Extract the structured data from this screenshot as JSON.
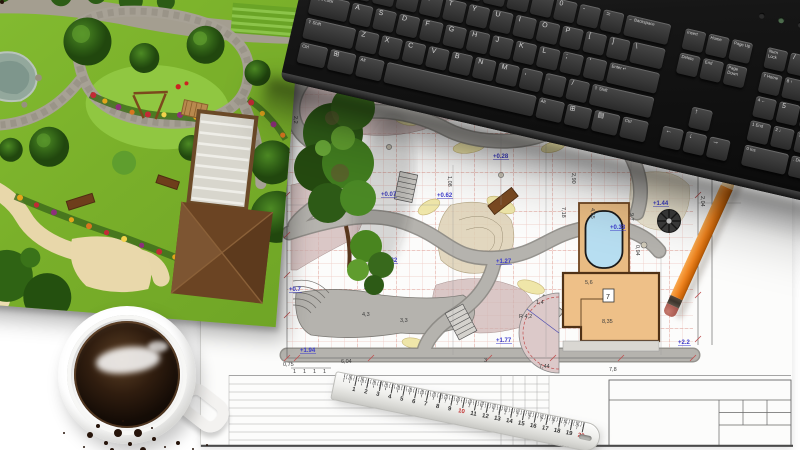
{
  "scene_title": "Garden landscape design workspace photo",
  "colors": {
    "lawn_green": "#7db32c",
    "plan_grid_pink": "#eec6c0",
    "plan_grid_red": "#dc958b",
    "elevation_blue": "#3a3acc",
    "pool_blue": "#b7def1",
    "deck_tan": "#e9bc83",
    "pencil_orange": "#ef8420",
    "ruler_red": "#c03030",
    "keyboard_black": "#161616"
  },
  "keyboard": {
    "unit": 24,
    "keyH": 21,
    "rows": [
      {
        "y": 88,
        "x": 12,
        "keys": [
          [
            "`",
            1
          ],
          [
            "1",
            1
          ],
          [
            "2",
            1
          ],
          [
            "3",
            1
          ],
          [
            "4",
            1
          ],
          [
            "5",
            1
          ],
          [
            "6",
            1
          ],
          [
            "7",
            1
          ],
          [
            "8",
            1
          ],
          [
            "9",
            1
          ],
          [
            "0",
            1
          ],
          [
            "-",
            1
          ],
          [
            "=",
            1
          ],
          [
            "← Backspace",
            2,
            "s"
          ]
        ]
      },
      {
        "y": 113,
        "x": 12,
        "keys": [
          [
            "Tab",
            1.5,
            "s"
          ],
          [
            "Q",
            1
          ],
          [
            "W",
            1
          ],
          [
            "E",
            1
          ],
          [
            "R",
            1
          ],
          [
            "T",
            1
          ],
          [
            "Y",
            1
          ],
          [
            "U",
            1
          ],
          [
            "I",
            1
          ],
          [
            "O",
            1
          ],
          [
            "P",
            1
          ],
          [
            "[",
            1
          ],
          [
            "]",
            1
          ],
          [
            "\\",
            1.5
          ]
        ]
      },
      {
        "y": 138,
        "x": 12,
        "keys": [
          [
            "Caps Lock",
            1.75,
            "s"
          ],
          [
            "A",
            1
          ],
          [
            "S",
            1
          ],
          [
            "D",
            1
          ],
          [
            "F",
            1
          ],
          [
            "G",
            1
          ],
          [
            "H",
            1
          ],
          [
            "J",
            1
          ],
          [
            "K",
            1
          ],
          [
            "L",
            1
          ],
          [
            ";",
            1
          ],
          [
            "'",
            1
          ],
          [
            "Enter ↵",
            2.25,
            "s"
          ]
        ]
      },
      {
        "y": 163,
        "x": 12,
        "keys": [
          [
            "⇧ Shift",
            2.25,
            "s"
          ],
          [
            "Z",
            1
          ],
          [
            "X",
            1
          ],
          [
            "C",
            1
          ],
          [
            "V",
            1
          ],
          [
            "B",
            1
          ],
          [
            "N",
            1
          ],
          [
            "M",
            1
          ],
          [
            ",",
            1
          ],
          [
            ".",
            1
          ],
          [
            "/",
            1
          ],
          [
            "⇧ Shift",
            2.75,
            "s"
          ]
        ]
      },
      {
        "y": 188,
        "x": 12,
        "keys": [
          [
            "Ctrl",
            1.3,
            "s"
          ],
          [
            "⊞",
            1.2
          ],
          [
            "Alt",
            1.2,
            "s"
          ],
          [
            "",
            6.5
          ],
          [
            "Alt",
            1.2,
            "s"
          ],
          [
            "⊞",
            1.2
          ],
          [
            "▤",
            1.2
          ],
          [
            "Ctrl",
            1.2,
            "s"
          ]
        ]
      },
      {
        "y": 88,
        "x": 384,
        "keys": [
          [
            "Insert",
            1,
            "s"
          ],
          [
            "Home",
            1,
            "s"
          ],
          [
            "Page Up",
            1,
            "s"
          ]
        ]
      },
      {
        "y": 113,
        "x": 384,
        "keys": [
          [
            "Delete",
            1,
            "s"
          ],
          [
            "End",
            1,
            "s"
          ],
          [
            "Page Down",
            1,
            "s"
          ]
        ]
      },
      {
        "y": 163,
        "x": 408,
        "keys": [
          [
            "↑",
            1
          ]
        ]
      },
      {
        "y": 188,
        "x": 384,
        "keys": [
          [
            "←",
            1
          ],
          [
            "↓",
            1
          ],
          [
            "→",
            1
          ]
        ]
      },
      {
        "y": 88,
        "x": 468,
        "keys": [
          [
            "Num Lock",
            1,
            "s"
          ],
          [
            "/",
            1
          ],
          [
            "*",
            1
          ],
          [
            "-",
            1
          ]
        ]
      },
      {
        "y": 113,
        "x": 468,
        "keys": [
          [
            "7 Home",
            1,
            "s"
          ],
          [
            "8 ↑",
            1,
            "s"
          ],
          [
            "9 PgUp",
            1,
            "s"
          ],
          [
            "+",
            1,
            "s",
            46
          ]
        ]
      },
      {
        "y": 138,
        "x": 468,
        "keys": [
          [
            "4 ←",
            1,
            "s"
          ],
          [
            "5",
            1
          ],
          [
            "6 →",
            1,
            "s"
          ]
        ]
      },
      {
        "y": 163,
        "x": 468,
        "keys": [
          [
            "1 End",
            1,
            "s"
          ],
          [
            "2 ↓",
            1,
            "s"
          ],
          [
            "3 PgDn",
            1,
            "s"
          ],
          [
            "Enter",
            1,
            "s",
            46
          ]
        ]
      },
      {
        "y": 188,
        "x": 468,
        "keys": [
          [
            "0 Ins",
            2,
            "s"
          ],
          [
            ". Del",
            1,
            "s"
          ]
        ]
      }
    ]
  },
  "ruler": {
    "numbers": [
      "1",
      "2",
      "3",
      "4",
      "5",
      "6",
      "7",
      "8",
      "9",
      "10",
      "11",
      "12",
      "13",
      "14",
      "15",
      "16",
      "17",
      "18",
      "19",
      "20"
    ],
    "red_numbers": [
      "10",
      "20"
    ]
  },
  "plan": {
    "room_label": "7",
    "radius_label": "R 4,2",
    "note": "rice",
    "elevations": [
      {
        "t": "+0.02",
        "x": 104,
        "y": 100
      },
      {
        "t": "+0.28",
        "x": 292,
        "y": 103
      },
      {
        "t": "+0.07",
        "x": 180,
        "y": 141
      },
      {
        "t": "+0.62",
        "x": 236,
        "y": 142
      },
      {
        "t": "+0.30",
        "x": 163,
        "y": 232
      },
      {
        "t": "+0.82",
        "x": 181,
        "y": 207
      },
      {
        "t": "+1.27",
        "x": 295,
        "y": 208
      },
      {
        "t": "+0.33",
        "x": 409,
        "y": 174
      },
      {
        "t": "+1.44",
        "x": 452,
        "y": 150
      },
      {
        "t": "+1.77",
        "x": 295,
        "y": 287
      },
      {
        "t": "+2.2",
        "x": 477,
        "y": 289
      },
      {
        "t": "+0.7",
        "x": 88,
        "y": 236
      },
      {
        "t": "+1.94",
        "x": 99,
        "y": 297
      }
    ],
    "dims": [
      {
        "t": "0,75",
        "x": 82,
        "y": 311
      },
      {
        "t": "6,04",
        "x": 140,
        "y": 308
      },
      {
        "t": "3",
        "x": 283,
        "y": 307
      },
      {
        "t": "7,44",
        "x": 338,
        "y": 313
      },
      {
        "t": "7,8",
        "x": 408,
        "y": 316
      },
      {
        "t": "1",
        "x": 92,
        "y": 318
      },
      {
        "t": "1",
        "x": 102,
        "y": 318
      },
      {
        "t": "1",
        "x": 112,
        "y": 318
      },
      {
        "t": "1",
        "x": 122,
        "y": 318
      },
      {
        "t": "1,02",
        "x": 128,
        "y": 79
      },
      {
        "t": "3,8",
        "x": 306,
        "y": 47
      },
      {
        "t": "0,7",
        "x": 329,
        "y": 45
      },
      {
        "t": "8,72",
        "x": 145,
        "y": 68
      },
      {
        "t": "2,7",
        "x": 481,
        "y": 94,
        "r": 90
      },
      {
        "t": "2,90",
        "x": 371,
        "y": 118,
        "r": 90
      },
      {
        "t": "9,7",
        "x": 429,
        "y": 158,
        "r": 90
      },
      {
        "t": "7,18",
        "x": 361,
        "y": 152,
        "r": 90
      },
      {
        "t": "5,6",
        "x": 384,
        "y": 229
      },
      {
        "t": "8,35",
        "x": 401,
        "y": 268
      },
      {
        "t": "2,04",
        "x": 500,
        "y": 141,
        "r": 90
      },
      {
        "t": "8,19",
        "x": 512,
        "y": 109,
        "r": 90
      },
      {
        "t": "4,3",
        "x": 161,
        "y": 261
      },
      {
        "t": "3,3",
        "x": 199,
        "y": 267
      },
      {
        "t": "1,4",
        "x": 335,
        "y": 249
      },
      {
        "t": "2,95",
        "x": 151,
        "y": 189,
        "r": 90
      },
      {
        "t": "1,08",
        "x": 247,
        "y": 121,
        "r": 90
      },
      {
        "t": "2,2",
        "x": 93,
        "y": 61,
        "r": 90
      },
      {
        "t": "4,55",
        "x": 390,
        "y": 153,
        "r": 90
      },
      {
        "t": "0,94",
        "x": 435,
        "y": 190,
        "r": 90
      }
    ]
  }
}
